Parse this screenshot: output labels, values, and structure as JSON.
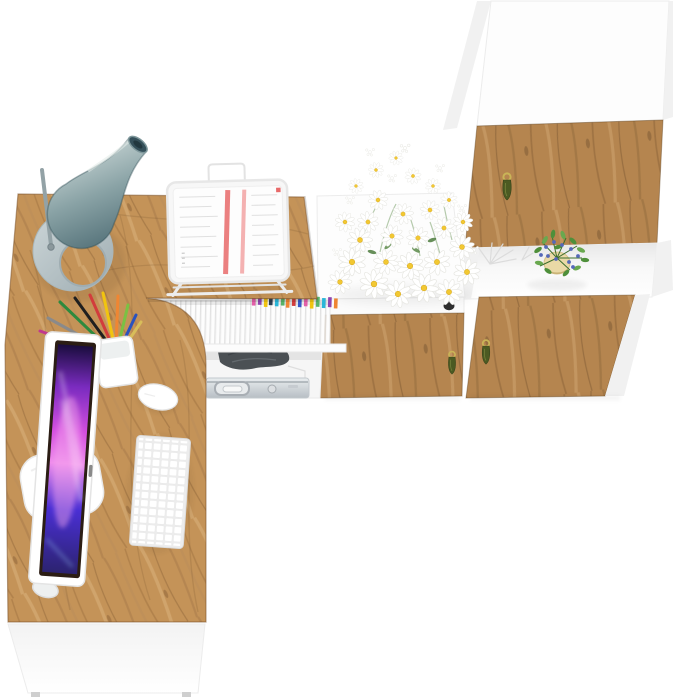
{
  "meta": {
    "title": "Top-down render of an L-shaped oak and white home-office desk set with tall cabinet",
    "canvas": {
      "width": 673,
      "height": 700
    },
    "background": "#ffffff"
  },
  "palette": {
    "wood_desk": "#c49358",
    "wood_door": "#b5854f",
    "wood_grain_dark": "#8a6138",
    "wood_grain_mid": "#a97c4b",
    "wood_grain_light": "#dcb57f",
    "furniture_white": "#fdfdfd",
    "panel_gray": "#f1f1f1",
    "lamp_light": "#d3dedd",
    "lamp_mid": "#8aa3a6",
    "lamp_dark": "#4e6c74",
    "lamp_base_light": "#ccd6d8",
    "lamp_base_dark": "#9fadb2",
    "lamp_opening": "#35505a",
    "screen_dark": "#1a0d3e",
    "screen_violet": "#7a2bbf",
    "screen_magenta": "#d44fe0",
    "screen_pink": "#ef8cec",
    "screen_indigo": "#4a2fd4",
    "screen_blue": "#2c2370",
    "bezel_dark": "#2b1d14",
    "handle_gold": "#c9b457",
    "handle_olive": "#4b5a22",
    "daisy_center": "#f2c832",
    "plant_leaf": "#4e8f3a",
    "plant_leaf_light": "#69a84f",
    "plant_berry": "#5668b8",
    "plant_pot": "#ead9a6",
    "knob_dark": "#303030",
    "case_silver_light": "#e9edef",
    "case_silver_dark": "#b7bec4",
    "bag_gray": "#4b5054",
    "paper_red": "#e86a6a",
    "paper_red_light": "#f2a3a3"
  },
  "objects": [
    {
      "name": "desk-lamp",
      "desc": "teal cone lamp on oval base, top-left desk corner"
    },
    {
      "name": "l-shaped-desk",
      "desc": "oak L-shaped desktop with rounded inner corner and white front panel"
    },
    {
      "name": "document-rack",
      "desc": "white wire rack holding printed papers with red stripes"
    },
    {
      "name": "file-shelf",
      "desc": "under-desk shelf of white files with colored clips"
    },
    {
      "name": "storage-shelf",
      "desc": "open shelf with aluminium case and gray pouch"
    },
    {
      "name": "middle-cabinet",
      "desc": "low cabinet: white top, white drawer, oak drawer front"
    },
    {
      "name": "daisy-bouquet",
      "desc": "white daisies with yellow centers on cabinet top"
    },
    {
      "name": "tall-cabinet",
      "desc": "tall white cabinet with two oak doors and open shelf"
    },
    {
      "name": "potted-plant",
      "desc": "green plant with blue berries in beige pot"
    },
    {
      "name": "monitor",
      "desc": "white-framed monitor with purple abstract wallpaper"
    },
    {
      "name": "keyboard",
      "desc": "white compact keyboard"
    },
    {
      "name": "mouse",
      "desc": "white mouse"
    },
    {
      "name": "pencil-cup",
      "desc": "white cup with colored pens and pencils"
    }
  ],
  "clips": [
    "#e25fa8",
    "#8e44ad",
    "#f1c40f",
    "#2c3e50",
    "#29b6d8",
    "#58b368",
    "#ef8633",
    "#d23c3c",
    "#3558c8",
    "#e25fa8",
    "#f1c40f",
    "#58b368",
    "#29b6d8",
    "#8e44ad",
    "#ef8633"
  ],
  "pencils": [
    "#2d8a3e",
    "#1f1f1f",
    "#d23c3c",
    "#f1c40f",
    "#ef8633",
    "#7ac143",
    "#2a52be",
    "#8a8a8a",
    "#c0398f",
    "#d8bd5a",
    "#2d8a3e",
    "#1f1f1f",
    "#8a4b2a"
  ]
}
